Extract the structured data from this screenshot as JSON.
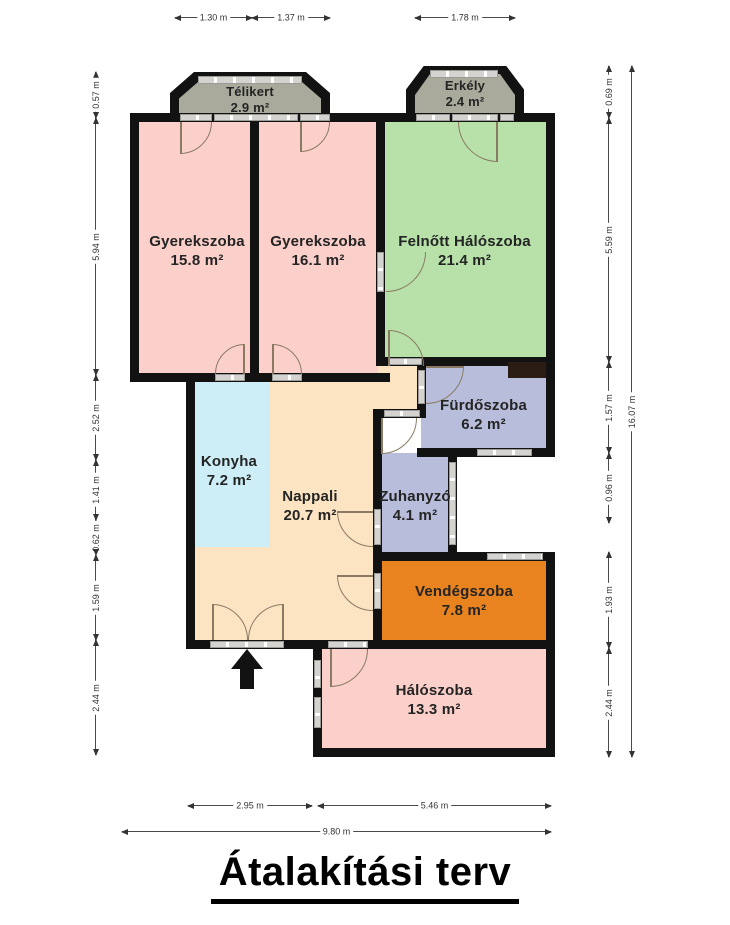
{
  "title": "Átalakítási terv",
  "palette": {
    "wall": "#121212",
    "room_pink": "#fcd0ca",
    "room_green": "#b7e1a8",
    "room_lavender": "#b7bdda",
    "room_peach": "#fce4c3",
    "room_blue": "#cdeef6",
    "room_orange": "#e8831f",
    "bay_gray": "#a9aa9c",
    "window_gray": "#d4d3cf",
    "shaft_dark": "#2b1d14"
  },
  "rooms": {
    "telikert": {
      "name": "Télikert",
      "area": "2.9 m²"
    },
    "erkely": {
      "name": "Erkély",
      "area": "2.4 m²"
    },
    "gyerekszoba1": {
      "name": "Gyerekszoba",
      "area": "15.8 m²"
    },
    "gyerekszoba2": {
      "name": "Gyerekszoba",
      "area": "16.1 m²"
    },
    "felnott_haloszoba": {
      "name": "Felnőtt Hálószoba",
      "area": "21.4 m²"
    },
    "furdoszoba": {
      "name": "Fürdőszoba",
      "area": "6.2 m²"
    },
    "konyha": {
      "name": "Konyha",
      "area": "7.2 m²"
    },
    "nappali": {
      "name": "Nappali",
      "area": "20.7 m²"
    },
    "zuhanyzo": {
      "name": "Zuhanyzó",
      "area": "4.1 m²"
    },
    "vendegszoba": {
      "name": "Vendégszoba",
      "area": "7.8 m²"
    },
    "haloszoba": {
      "name": "Hálószoba",
      "area": "13.3 m²"
    }
  },
  "dims": {
    "top": [
      "1.30 m",
      "1.37 m",
      "1.78 m"
    ],
    "left": [
      "0.57 m",
      "5.94 m",
      "2.52 m",
      "1.41 m",
      "0.62 m",
      "1.59 m",
      "2.44 m"
    ],
    "right": [
      "0.69 m",
      "5.59 m",
      "1.57 m",
      "0.96 m",
      "1.93 m",
      "2.44 m"
    ],
    "right_total": "16.07 m",
    "bottom": [
      "2.95 m",
      "5.46 m"
    ],
    "bottom_total": "9.80 m"
  }
}
